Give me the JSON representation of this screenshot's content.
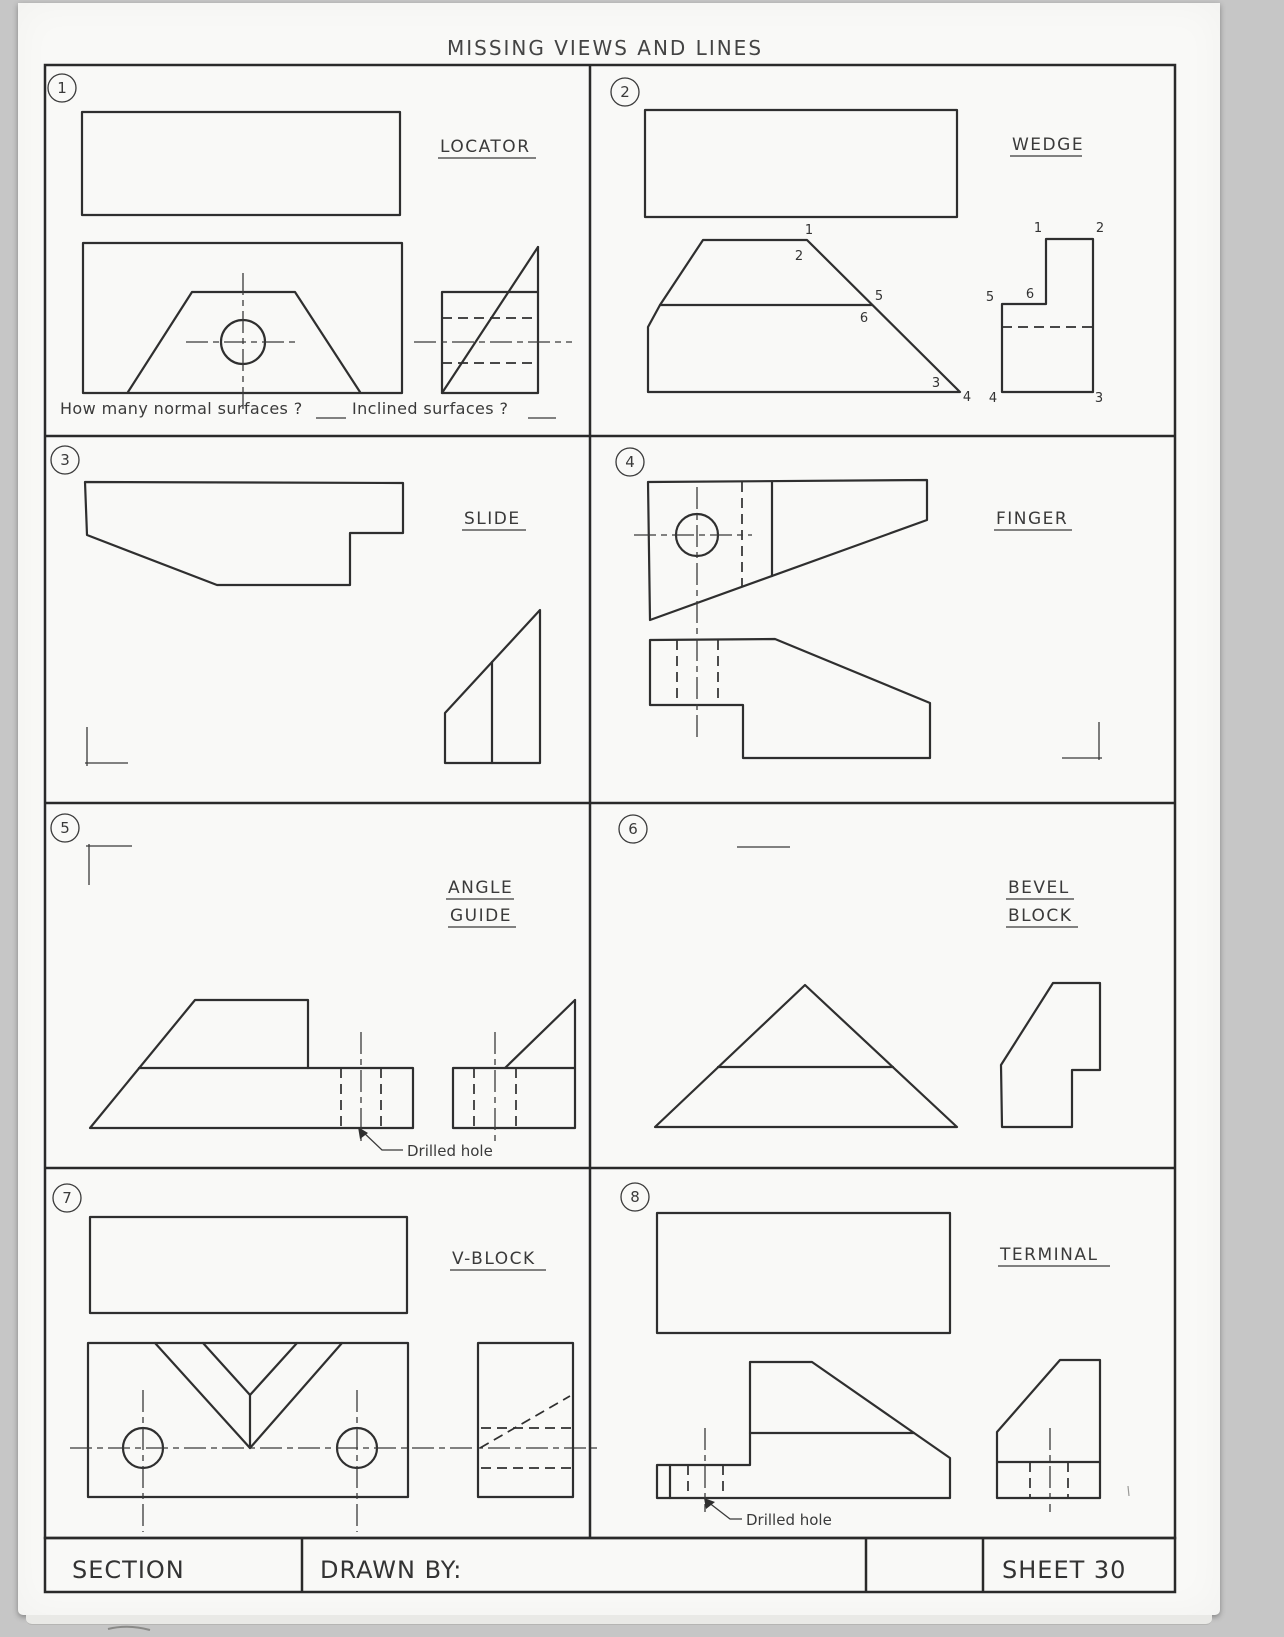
{
  "page": {
    "title": "MISSING VIEWS AND LINES"
  },
  "title_block": {
    "section": "SECTION",
    "drawn_by": "DRAWN BY:",
    "sheet": "SHEET 30"
  },
  "cells": [
    {
      "number": "1",
      "title": "LOCATOR",
      "question_1": "How many normal surfaces ?",
      "question_2": "Inclined surfaces ?"
    },
    {
      "number": "2",
      "title": "WEDGE",
      "front_labels": [
        "1",
        "2",
        "5",
        "6",
        "3",
        "4"
      ],
      "side_labels": [
        "1",
        "2",
        "5",
        "6",
        "4",
        "3"
      ]
    },
    {
      "number": "3",
      "title": "SLIDE"
    },
    {
      "number": "4",
      "title": "FINGER"
    },
    {
      "number": "5",
      "title_line1": "ANGLE",
      "title_line2": "GUIDE",
      "callout": "Drilled hole"
    },
    {
      "number": "6",
      "title_line1": "BEVEL",
      "title_line2": "BLOCK"
    },
    {
      "number": "7",
      "title": "V-BLOCK"
    },
    {
      "number": "8",
      "title": "TERMINAL",
      "callout": "Drilled hole"
    }
  ],
  "colors": {
    "ink": "#2f2f2f",
    "paper": "#f9f9f7",
    "background": "#c6c6c6"
  }
}
